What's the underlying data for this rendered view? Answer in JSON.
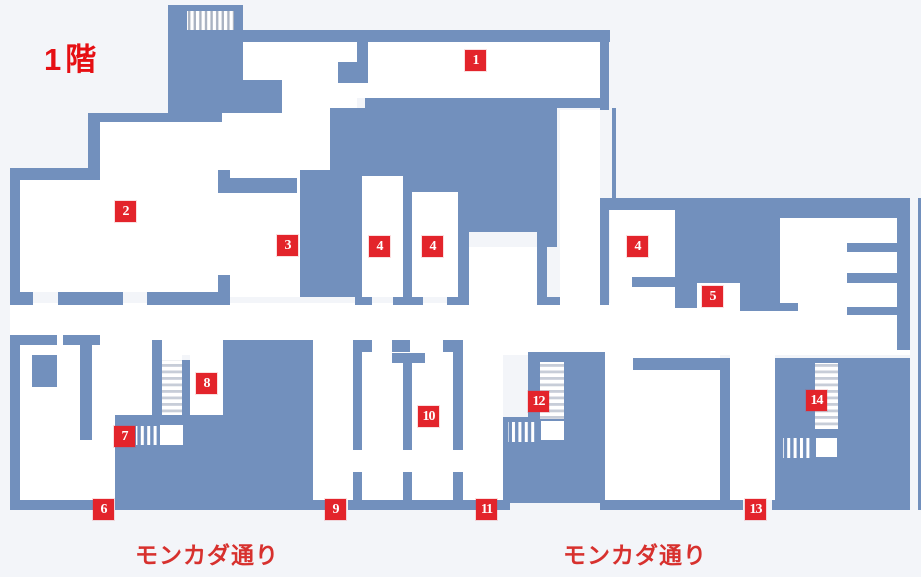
{
  "title": {
    "text": "1階"
  },
  "street_labels": [
    {
      "text": "モンカダ通り"
    },
    {
      "text": "モンカダ通り"
    }
  ],
  "colors": {
    "wall_blue": "#7290bd",
    "room_white": "#ffffff",
    "background": "#f3f5f9",
    "marker_red": "#e3242b",
    "label_red": "#d7312e",
    "title_red": "#e60f13",
    "stair_stripe_gray": "#c7cdd8"
  },
  "markers": [
    {
      "label": "1",
      "x": 465,
      "y": 50
    },
    {
      "label": "2",
      "x": 115,
      "y": 201
    },
    {
      "label": "3",
      "x": 277,
      "y": 235
    },
    {
      "label": "4",
      "x": 369,
      "y": 236
    },
    {
      "label": "4",
      "x": 422,
      "y": 236
    },
    {
      "label": "4",
      "x": 627,
      "y": 236
    },
    {
      "label": "5",
      "x": 702,
      "y": 286
    },
    {
      "label": "6",
      "x": 93,
      "y": 499
    },
    {
      "label": "7",
      "x": 114,
      "y": 426
    },
    {
      "label": "8",
      "x": 196,
      "y": 373
    },
    {
      "label": "9",
      "x": 325,
      "y": 499
    },
    {
      "label": "10",
      "x": 418,
      "y": 406
    },
    {
      "label": "11",
      "x": 476,
      "y": 499
    },
    {
      "label": "12",
      "x": 528,
      "y": 391
    },
    {
      "label": "13",
      "x": 745,
      "y": 499
    },
    {
      "label": "14",
      "x": 806,
      "y": 390
    }
  ]
}
